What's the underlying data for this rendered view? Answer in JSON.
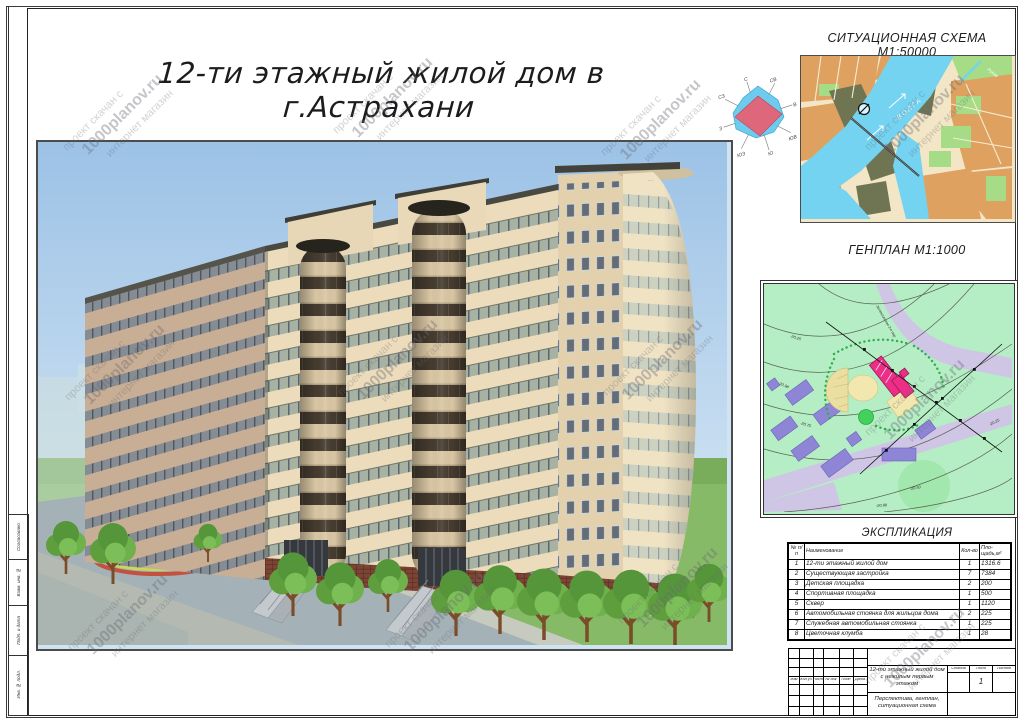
{
  "sheet": {
    "title": "12-ти этажный жилой дом в г.Астрахани"
  },
  "watermark": {
    "line1": "проект скачан с",
    "line2": "1000planov.ru",
    "line3": "интернет магазин"
  },
  "wind_rose": {
    "directions": [
      "С",
      "СВ",
      "В",
      "ЮВ",
      "Ю",
      "ЮЗ",
      "З",
      "СЗ"
    ],
    "cold_color": "#66c9ee",
    "warm_color": "#e85f72"
  },
  "situational_scheme": {
    "label": "СИТУАЦИОННАЯ СХЕМА М1:50000",
    "river_label": "ВОЛГА",
    "branch_label": "Рукав",
    "river_color": "#74d3f0",
    "urban_color": "#dfa160",
    "green_color": "#a5dc85"
  },
  "genplan": {
    "label": "ГЕНПЛАН М1:1000",
    "street_label": "Зеленгинская 3-я пер.",
    "contour_labels": [
      "-20.25",
      "-20.98",
      "-20.75",
      "-20.50",
      "-20.25",
      "-20.98"
    ],
    "new_building_color": "#ec2e86",
    "existing_building_color": "#8e85d6"
  },
  "explication": {
    "label": "ЭКСПЛИКАЦИЯ",
    "columns": {
      "num": "№ п/п",
      "name": "Наименование",
      "qty": "Кол-во",
      "area": "Пло-щадь,м²"
    },
    "rows": [
      {
        "num": "1",
        "name": "12-ти этажный жилой дом",
        "qty": "1",
        "area": "1316.6"
      },
      {
        "num": "2",
        "name": "Существующая застройка",
        "qty": "7",
        "area": "7384"
      },
      {
        "num": "3",
        "name": "Детская площадка",
        "qty": "2",
        "area": "200"
      },
      {
        "num": "4",
        "name": "Спортивная площадка",
        "qty": "1",
        "area": "500"
      },
      {
        "num": "5",
        "name": "Сквер",
        "qty": "1",
        "area": "1120"
      },
      {
        "num": "6",
        "name": "Автомобильная стоянка для жильцов дома",
        "qty": "2",
        "area": "225"
      },
      {
        "num": "7",
        "name": "Служебная автомобильная стоянка",
        "qty": "1",
        "area": "225"
      },
      {
        "num": "8",
        "name": "Цветочная клумба",
        "qty": "1",
        "area": "28"
      }
    ]
  },
  "title_block": {
    "header_cells": [
      "Изм",
      "Кол.уч",
      "Лист",
      "№ док",
      "Подп",
      "Дата"
    ],
    "project_name_line1": "12-ти этажный жилой дом",
    "project_name_line2": "с нежилым первым этажом",
    "sheet_content_line1": "Перспектива, генплан,",
    "sheet_content_line2": "ситуационная схема",
    "stage_label": "Стадия",
    "sheet_label": "Лист",
    "sheets_label": "Листов",
    "sheet_number": "1"
  },
  "side_strip": {
    "cells": [
      "Согласовано",
      "Взам. инв. №",
      "Подп. и дата",
      "Инв. № подл."
    ]
  }
}
